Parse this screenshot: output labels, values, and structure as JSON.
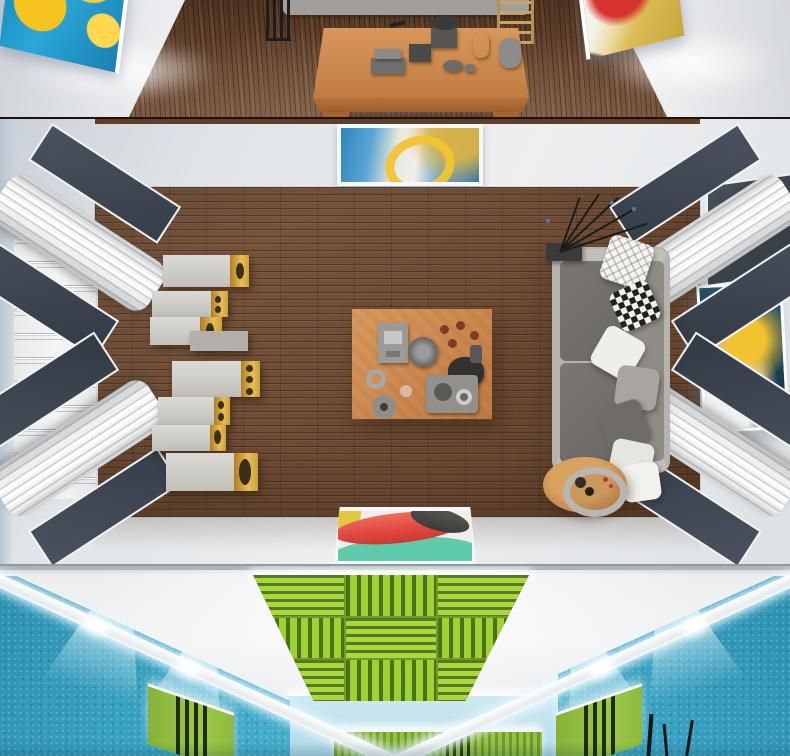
{
  "image": {
    "kind": "3d-interior-render-collage",
    "alt": "Three stacked 3D renders of an acoustically treated hi-fi listening room",
    "sections": [
      {
        "id": "top-room",
        "view": "eye-level perspective",
        "description": "White gallery walls with two backlit abstract paintings (blue-and-yellow on the left, red-and-gold on the right), dark walnut plank floor, low light-wood coffee table covered with grey ceramic decor in front of a grey sofa, black magazine rack and small wooden ladder shelf",
        "objects": [
          {
            "name": "painting-blue-yellow",
            "colors": [
              "#2aa7d8",
              "#f6c41f"
            ]
          },
          {
            "name": "painting-red-gold",
            "colors": [
              "#d6332c",
              "#d9b84e",
              "#f5f2ec"
            ]
          },
          {
            "name": "coffee-table",
            "color": "#c9854a",
            "decor": "grey boxes, vases, bowls, bird figurine, dark plant"
          },
          {
            "name": "sofa-edge",
            "color": "#a09f9b"
          },
          {
            "name": "magazine-rack",
            "color": "#1d1d1d"
          },
          {
            "name": "ladder-shelf",
            "color": "#caa36b"
          },
          {
            "name": "walnut-floor",
            "color": "#6a4830"
          }
        ]
      },
      {
        "id": "middle-room",
        "view": "top-down plan",
        "description": "Living room seen from above: walnut plank rug area on a pale floor, grey three-seat sofa with seven assorted cushions, column of eight gold-fronted loudspeakers, wooden coffee table with amplifier, teapot, cups and trays, round wooden side table with grey ring tray, black branch sculpture, three abstract paintings (blue-gold top, navy-yellow right, mint-red bottom), white slatted corner diffusers with slate panels in all four corners, ribbed white wall panel on the left",
        "objects": [
          {
            "name": "speakers",
            "count": 8,
            "colors": [
              "#d6d4d0",
              "#d9a33c"
            ]
          },
          {
            "name": "sofa",
            "color": "#b6b3ae",
            "cushion_color": "#6f6c67",
            "pillows": 7,
            "pillow_styles": [
              "white diamond lattice",
              "black-white checker",
              "white",
              "grey",
              "dark grey",
              "cream",
              "white"
            ]
          },
          {
            "name": "coffee-table",
            "color": "#cd8a50"
          },
          {
            "name": "side-table",
            "color": "#c08148",
            "tray": "#b9b6b1"
          },
          {
            "name": "branch-sculpture",
            "color": "#1c1c1a",
            "tips": "#4a80b0"
          },
          {
            "name": "corner-diffusers",
            "count": 4,
            "colors": [
              "#f4f6f7",
              "#3d4551"
            ]
          },
          {
            "name": "ribbed-wall-panel",
            "color": "#f0f2f3"
          },
          {
            "name": "painting-top",
            "colors": [
              "#2f86c0",
              "#f2c430",
              "#e9e6df"
            ]
          },
          {
            "name": "painting-right",
            "colors": [
              "#1d4a60",
              "#f2c230",
              "#eef2f4"
            ]
          },
          {
            "name": "painting-bottom",
            "colors": [
              "#5ecbaa",
              "#e0483e",
              "#3c3b39",
              "#e3c93f"
            ]
          },
          {
            "name": "walnut-rug",
            "color": "#6f4d36"
          }
        ]
      },
      {
        "id": "bottom-room",
        "view": "upward ceiling view",
        "description": "Looking up: lime-green slatted acoustic ceiling raft with alternating slat directions and LED edge strip over a white ceiling, turquoise felt side walls washed by recessed round spotlights and diagonal LED cove bands, backlit lime-green slat panels on the far and side walls, thin black branch decor",
        "objects": [
          {
            "name": "ceiling-acoustic-panel",
            "colors": [
              "#9ed134",
              "#567a1b"
            ],
            "layout": "3x3 alternating slat grid"
          },
          {
            "name": "felt-wall",
            "color": "#3fa9c8"
          },
          {
            "name": "spotlights",
            "count": 4,
            "color": "#ffffff"
          },
          {
            "name": "led-cove-bands",
            "color": "#ffffff"
          },
          {
            "name": "green-wall-panels",
            "count": 3,
            "colors": [
              "#94c244",
              "#273618"
            ]
          },
          {
            "name": "branch-decor",
            "color": "#141412"
          }
        ]
      }
    ]
  },
  "palette": {
    "walnut_dark": "#5e3f28",
    "walnut_mid": "#6f4d36",
    "table_wood": "#cd8a50",
    "wall_white": "#edeff1",
    "floor_border": "#dde1e4",
    "slate_panel": "#3d4551",
    "speaker_gold": "#d9a33c",
    "sofa_grey": "#b6b3ae",
    "cushion_grey": "#6f6c67",
    "felt_teal": "#3fa9c8",
    "acoustic_green": "#9ed134",
    "acoustic_green_dark": "#567a1b",
    "paint_blue": "#2f86c0",
    "paint_yellow": "#f2c430",
    "paint_red": "#e0483e",
    "paint_mint": "#5ecbaa"
  }
}
